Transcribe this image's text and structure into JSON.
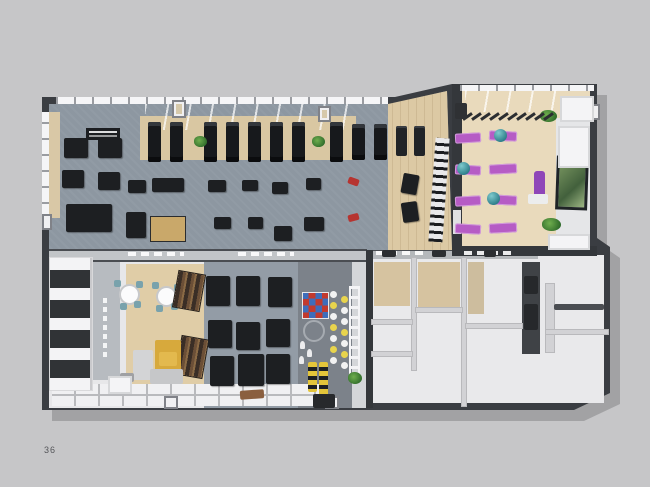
{
  "page": {
    "number": "36",
    "background": "#c6c6c8"
  },
  "scene": {
    "description": "3D top-down rendering of a fitness club floor plan on a catalogue page",
    "rooms": [
      {
        "id": "gym-hall",
        "label": "cardio and strength gym hall"
      },
      {
        "id": "functional-zone",
        "label": "functional training zone with wall bars"
      },
      {
        "id": "group-studio",
        "label": "group fitness / yoga studio"
      },
      {
        "id": "lounge-cafe",
        "label": "lounge and cafe corner"
      },
      {
        "id": "machine-zone",
        "label": "lower cardio machine zone"
      },
      {
        "id": "climbing-kids-zone",
        "label": "climbing wall and kids corner"
      },
      {
        "id": "locker-rooms",
        "label": "locker and changing rooms"
      },
      {
        "id": "storage-shelving",
        "label": "storage shelving wall"
      }
    ],
    "equipment_counts": {
      "treadmills": 8,
      "exercise_bikes": 2,
      "weight_towers": 2,
      "strength_machines": 21,
      "yoga_mats": 8,
      "gym_balls": 3,
      "cafe_tables": 2,
      "cafe_chairs": 8,
      "bookshelves": 2,
      "sofas": 1,
      "climbing_hold_panels": 1,
      "rope_ladders": 1,
      "plants": 7
    },
    "colors": {
      "wall_dark": "#3a3d42",
      "gym_carpet": "#8d97a1",
      "wood_floor": "#dcc9a4",
      "studio_wood": "#e9dabc",
      "white_room": "#e9e9eb",
      "tan_wall": "#d6c3a0",
      "mat_purple": "#b65cc5",
      "ball_teal": "#2e7f8a",
      "sofa_yellow": "#d7a93c",
      "accent_red": "#b63430",
      "plant_green": "#2f6b2a",
      "hold_red": "#c23a2e",
      "hold_blue": "#3e6dbb"
    }
  },
  "sprites": [
    {
      "n": "treadmill",
      "t": "tread",
      "x": 148,
      "y": 122,
      "w": 13,
      "h": 40
    },
    {
      "n": "treadmill",
      "t": "tread",
      "x": 170,
      "y": 122,
      "w": 13,
      "h": 40
    },
    {
      "n": "treadmill",
      "t": "tread",
      "x": 204,
      "y": 122,
      "w": 13,
      "h": 40
    },
    {
      "n": "treadmill",
      "t": "tread",
      "x": 226,
      "y": 122,
      "w": 13,
      "h": 40
    },
    {
      "n": "treadmill",
      "t": "tread",
      "x": 248,
      "y": 122,
      "w": 13,
      "h": 40
    },
    {
      "n": "treadmill",
      "t": "tread",
      "x": 270,
      "y": 122,
      "w": 13,
      "h": 40
    },
    {
      "n": "treadmill",
      "t": "tread",
      "x": 292,
      "y": 122,
      "w": 13,
      "h": 40
    },
    {
      "n": "treadmill",
      "t": "tread",
      "x": 330,
      "y": 122,
      "w": 13,
      "h": 40
    },
    {
      "n": "exercise-bike",
      "t": "tread",
      "x": 352,
      "y": 124,
      "w": 13,
      "h": 36
    },
    {
      "n": "exercise-bike",
      "t": "tread",
      "x": 374,
      "y": 124,
      "w": 13,
      "h": 36
    },
    {
      "n": "weight-tower",
      "t": "tower",
      "x": 396,
      "y": 126,
      "w": 11,
      "h": 30
    },
    {
      "n": "weight-tower",
      "t": "tower",
      "x": 414,
      "y": 126,
      "w": 11,
      "h": 30
    },
    {
      "n": "plant",
      "t": "plant",
      "x": 194,
      "y": 136,
      "w": 13,
      "h": 11
    },
    {
      "n": "plant",
      "t": "plant",
      "x": 312,
      "y": 136,
      "w": 13,
      "h": 11
    },
    {
      "n": "bench-station",
      "t": "mach",
      "x": 64,
      "y": 138,
      "w": 24,
      "h": 20
    },
    {
      "n": "bench-station",
      "t": "mach",
      "x": 98,
      "y": 138,
      "w": 24,
      "h": 20
    },
    {
      "n": "bench-station",
      "t": "mach",
      "x": 62,
      "y": 170,
      "w": 22,
      "h": 18
    },
    {
      "n": "bench-station",
      "t": "mach",
      "x": 98,
      "y": 172,
      "w": 22,
      "h": 18
    },
    {
      "n": "cable-crossover",
      "t": "mach",
      "x": 66,
      "y": 204,
      "w": 46,
      "h": 28
    },
    {
      "n": "gym-machine",
      "t": "mach",
      "x": 128,
      "y": 180,
      "w": 18,
      "h": 13
    },
    {
      "n": "gym-machine",
      "t": "mach",
      "x": 152,
      "y": 178,
      "w": 32,
      "h": 14
    },
    {
      "n": "gym-machine",
      "t": "mach",
      "x": 208,
      "y": 180,
      "w": 18,
      "h": 12
    },
    {
      "n": "gym-machine",
      "t": "mach",
      "x": 242,
      "y": 180,
      "w": 16,
      "h": 11
    },
    {
      "n": "gym-machine",
      "t": "mach",
      "x": 272,
      "y": 182,
      "w": 16,
      "h": 12
    },
    {
      "n": "gym-machine",
      "t": "mach",
      "x": 306,
      "y": 178,
      "w": 15,
      "h": 12
    },
    {
      "n": "gym-machine",
      "t": "mach",
      "x": 126,
      "y": 212,
      "w": 20,
      "h": 26
    },
    {
      "n": "wooden-machine",
      "t": "wmach",
      "x": 150,
      "y": 216,
      "w": 36,
      "h": 26
    },
    {
      "n": "gym-machine",
      "t": "mach",
      "x": 214,
      "y": 217,
      "w": 17,
      "h": 12
    },
    {
      "n": "gym-machine",
      "t": "mach",
      "x": 248,
      "y": 217,
      "w": 15,
      "h": 12
    },
    {
      "n": "gym-machine",
      "t": "mach",
      "x": 274,
      "y": 226,
      "w": 18,
      "h": 15
    },
    {
      "n": "gym-machine",
      "t": "mach",
      "x": 304,
      "y": 217,
      "w": 20,
      "h": 14
    },
    {
      "n": "dumbbell-rack",
      "t": "mach",
      "x": 402,
      "y": 174,
      "w": 16,
      "h": 20,
      "r": 10
    },
    {
      "n": "dumbbell-rack",
      "t": "mach",
      "x": 402,
      "y": 202,
      "w": 16,
      "h": 20,
      "r": -8
    },
    {
      "n": "red-equipment",
      "t": "block",
      "x": 348,
      "y": 178,
      "w": 11,
      "h": 7,
      "c": "#b63430",
      "r": 20
    },
    {
      "n": "red-equipment",
      "t": "block",
      "x": 348,
      "y": 214,
      "w": 11,
      "h": 7,
      "c": "#b63430",
      "r": -15
    },
    {
      "n": "wall-bars",
      "t": "wallbars",
      "x": 432,
      "y": 138,
      "w": 14,
      "h": 104,
      "r": 4
    },
    {
      "n": "wall-sign",
      "t": "sign",
      "x": 86,
      "y": 128,
      "w": 34,
      "h": 12
    },
    {
      "n": "pillar",
      "t": "pillar",
      "x": 172,
      "y": 100,
      "w": 14,
      "h": 18,
      "c": "#d6c9ab"
    },
    {
      "n": "pillar",
      "t": "pillar",
      "x": 318,
      "y": 106,
      "w": 13,
      "h": 16,
      "c": "#d6c9ab"
    },
    {
      "n": "pillar",
      "t": "pillar",
      "x": 42,
      "y": 214,
      "w": 10,
      "h": 16
    },
    {
      "n": "pillar",
      "t": "pillar",
      "x": 164,
      "y": 396,
      "w": 14,
      "h": 13
    },
    {
      "n": "pillar",
      "t": "pillar",
      "x": 325,
      "y": 396,
      "w": 14,
      "h": 13
    },
    {
      "n": "pillar",
      "t": "pillar",
      "x": 588,
      "y": 104,
      "w": 12,
      "h": 16
    },
    {
      "n": "wall-signage",
      "t": "dash",
      "x": 128,
      "y": 252,
      "w": 56,
      "h": 4
    },
    {
      "n": "wall-signage",
      "t": "dash",
      "x": 238,
      "y": 252,
      "w": 56,
      "h": 4
    },
    {
      "n": "wall-signage",
      "t": "dash",
      "x": 376,
      "y": 251,
      "w": 52,
      "h": 4
    },
    {
      "n": "wall-signage",
      "t": "dash",
      "x": 464,
      "y": 251,
      "w": 52,
      "h": 4
    },
    {
      "n": "wall-signage-vertical",
      "t": "vdash",
      "x": 103,
      "y": 298,
      "w": 4,
      "h": 62
    },
    {
      "n": "yoga-mat",
      "t": "mat",
      "x": 455,
      "y": 133,
      "w": 26,
      "h": 10,
      "r": -3
    },
    {
      "n": "yoga-mat",
      "t": "mat",
      "x": 489,
      "y": 131,
      "w": 28,
      "h": 10,
      "r": 3
    },
    {
      "n": "yoga-mat",
      "t": "mat",
      "x": 455,
      "y": 165,
      "w": 26,
      "h": 10,
      "r": 3
    },
    {
      "n": "yoga-mat",
      "t": "mat",
      "x": 489,
      "y": 164,
      "w": 28,
      "h": 10,
      "r": -3
    },
    {
      "n": "yoga-mat",
      "t": "mat",
      "x": 455,
      "y": 196,
      "w": 26,
      "h": 10,
      "r": -3
    },
    {
      "n": "yoga-mat",
      "t": "mat",
      "x": 489,
      "y": 195,
      "w": 28,
      "h": 10,
      "r": 3
    },
    {
      "n": "yoga-mat",
      "t": "mat",
      "x": 455,
      "y": 224,
      "w": 26,
      "h": 10,
      "r": 3
    },
    {
      "n": "yoga-mat",
      "t": "mat",
      "x": 489,
      "y": 223,
      "w": 28,
      "h": 10,
      "r": -3
    },
    {
      "n": "gym-ball",
      "t": "ball",
      "x": 494,
      "y": 129,
      "w": 13,
      "h": 13
    },
    {
      "n": "gym-ball",
      "t": "ball",
      "x": 457,
      "y": 162,
      "w": 13,
      "h": 13
    },
    {
      "n": "gym-ball",
      "t": "ball",
      "x": 487,
      "y": 192,
      "w": 13,
      "h": 13
    },
    {
      "n": "rolled-mat",
      "t": "roll",
      "x": 534,
      "y": 171,
      "w": 11,
      "h": 27
    },
    {
      "n": "white-bench",
      "t": "block",
      "x": 528,
      "y": 194,
      "w": 20,
      "h": 10,
      "c": "#eceded"
    },
    {
      "n": "wall-art",
      "t": "art",
      "x": 556,
      "y": 156,
      "w": 32,
      "h": 54,
      "r": 2
    },
    {
      "n": "plant",
      "t": "plant",
      "x": 540,
      "y": 110,
      "w": 17,
      "h": 12
    },
    {
      "n": "plant",
      "t": "plant",
      "x": 542,
      "y": 218,
      "w": 19,
      "h": 13
    },
    {
      "n": "pergola-beam",
      "t": "beam",
      "x": 466,
      "y": 111,
      "w": 3,
      "h": 11,
      "r": 55
    },
    {
      "n": "pergola-beam",
      "t": "beam",
      "x": 475,
      "y": 111,
      "w": 3,
      "h": 11,
      "r": 55
    },
    {
      "n": "pergola-beam",
      "t": "beam",
      "x": 484,
      "y": 111,
      "w": 3,
      "h": 11,
      "r": 55
    },
    {
      "n": "pergola-beam",
      "t": "beam",
      "x": 493,
      "y": 111,
      "w": 3,
      "h": 11,
      "r": 55
    },
    {
      "n": "pergola-beam",
      "t": "beam",
      "x": 502,
      "y": 111,
      "w": 3,
      "h": 11,
      "r": 55
    },
    {
      "n": "pergola-beam",
      "t": "beam",
      "x": 511,
      "y": 111,
      "w": 3,
      "h": 11,
      "r": 55
    },
    {
      "n": "pergola-beam",
      "t": "beam",
      "x": 520,
      "y": 111,
      "w": 3,
      "h": 11,
      "r": 55
    },
    {
      "n": "pergola-beam",
      "t": "beam",
      "x": 529,
      "y": 111,
      "w": 3,
      "h": 11,
      "r": 55
    },
    {
      "n": "pergola-beam",
      "t": "beam",
      "x": 538,
      "y": 111,
      "w": 3,
      "h": 11,
      "r": 55
    },
    {
      "n": "pergola-beam",
      "t": "beam",
      "x": 547,
      "y": 111,
      "w": 3,
      "h": 11,
      "r": 55
    },
    {
      "n": "speaker-cabinet",
      "t": "block",
      "x": 455,
      "y": 103,
      "w": 12,
      "h": 16,
      "c": "#2f3134"
    },
    {
      "n": "white-cabinet",
      "t": "cab",
      "x": 558,
      "y": 126,
      "w": 32,
      "h": 42
    },
    {
      "n": "white-cabinet",
      "t": "cab",
      "x": 548,
      "y": 234,
      "w": 42,
      "h": 16
    },
    {
      "n": "window-block",
      "t": "cab",
      "x": 560,
      "y": 96,
      "w": 34,
      "h": 26
    },
    {
      "n": "cafe-table",
      "t": "table",
      "x": 121,
      "y": 286,
      "w": 17,
      "h": 17
    },
    {
      "n": "cafe-table",
      "t": "table",
      "x": 158,
      "y": 288,
      "w": 17,
      "h": 17
    },
    {
      "n": "cafe-chair",
      "t": "chair",
      "x": 114,
      "y": 280,
      "w": 7,
      "h": 7
    },
    {
      "n": "cafe-chair",
      "t": "chair",
      "x": 136,
      "y": 281,
      "w": 7,
      "h": 7
    },
    {
      "n": "cafe-chair",
      "t": "chair",
      "x": 120,
      "y": 303,
      "w": 7,
      "h": 7
    },
    {
      "n": "cafe-chair",
      "t": "chair",
      "x": 134,
      "y": 301,
      "w": 7,
      "h": 7
    },
    {
      "n": "cafe-chair",
      "t": "chair",
      "x": 152,
      "y": 282,
      "w": 7,
      "h": 7
    },
    {
      "n": "cafe-chair",
      "t": "chair",
      "x": 174,
      "y": 284,
      "w": 7,
      "h": 7
    },
    {
      "n": "cafe-chair",
      "t": "chair",
      "x": 156,
      "y": 305,
      "w": 7,
      "h": 7
    },
    {
      "n": "cafe-chair",
      "t": "chair",
      "x": 171,
      "y": 303,
      "w": 7,
      "h": 7
    },
    {
      "n": "bookshelf",
      "t": "shelf",
      "x": 176,
      "y": 273,
      "w": 26,
      "h": 36,
      "r": 10
    },
    {
      "n": "bookshelf",
      "t": "shelf",
      "x": 179,
      "y": 338,
      "w": 26,
      "h": 38,
      "r": 10
    },
    {
      "n": "sofa-back",
      "t": "sofa",
      "x": 155,
      "y": 340,
      "w": 26,
      "h": 36,
      "c": "#d7a93c"
    },
    {
      "n": "sofa-chaise",
      "t": "sofa",
      "x": 133,
      "y": 350,
      "w": 20,
      "h": 30,
      "c": "#d3d4d6"
    },
    {
      "n": "sofa-seat",
      "t": "sofa",
      "x": 150,
      "y": 369,
      "w": 33,
      "h": 15,
      "c": "#c6c7c9"
    },
    {
      "n": "sofa-cushion",
      "t": "sofa",
      "x": 159,
      "y": 352,
      "w": 18,
      "h": 14,
      "c": "#e3b94e"
    },
    {
      "n": "coffee-table",
      "t": "block",
      "x": 120,
      "y": 373,
      "w": 14,
      "h": 9,
      "c": "#9fa0a3"
    },
    {
      "n": "storage-shelving",
      "t": "unit",
      "x": 50,
      "y": 258,
      "w": 42,
      "h": 132
    },
    {
      "n": "white-cabinet",
      "t": "cab",
      "x": 108,
      "y": 376,
      "w": 24,
      "h": 18
    },
    {
      "n": "door-rug",
      "t": "block",
      "x": 240,
      "y": 390,
      "w": 24,
      "h": 9,
      "c": "#8a5f3f",
      "r": -4
    },
    {
      "n": "cardio-machine",
      "t": "mach",
      "x": 206,
      "y": 276,
      "w": 24,
      "h": 30
    },
    {
      "n": "cardio-machine",
      "t": "mach",
      "x": 236,
      "y": 276,
      "w": 24,
      "h": 30
    },
    {
      "n": "cardio-machine",
      "t": "mach",
      "x": 268,
      "y": 277,
      "w": 24,
      "h": 30
    },
    {
      "n": "cardio-machine",
      "t": "mach",
      "x": 208,
      "y": 320,
      "w": 24,
      "h": 28
    },
    {
      "n": "cardio-machine",
      "t": "mach",
      "x": 236,
      "y": 322,
      "w": 24,
      "h": 28
    },
    {
      "n": "cardio-machine",
      "t": "mach",
      "x": 266,
      "y": 319,
      "w": 24,
      "h": 28
    },
    {
      "n": "cardio-machine",
      "t": "mach",
      "x": 210,
      "y": 356,
      "w": 24,
      "h": 30
    },
    {
      "n": "cardio-machine",
      "t": "mach",
      "x": 238,
      "y": 354,
      "w": 26,
      "h": 32
    },
    {
      "n": "cardio-machine",
      "t": "mach",
      "x": 266,
      "y": 354,
      "w": 24,
      "h": 30
    },
    {
      "n": "climbing-holds-panel",
      "t": "holds",
      "x": 302,
      "y": 292,
      "w": 27,
      "h": 27
    },
    {
      "n": "climbing-hold",
      "t": "dot",
      "x": 330,
      "y": 291,
      "w": 7,
      "h": 7,
      "c": "#f2f2f2"
    },
    {
      "n": "climbing-hold",
      "t": "dot",
      "x": 330,
      "y": 302,
      "w": 7,
      "h": 7,
      "c": "#e8d44d"
    },
    {
      "n": "climbing-hold",
      "t": "dot",
      "x": 330,
      "y": 313,
      "w": 7,
      "h": 7,
      "c": "#f2f2f2"
    },
    {
      "n": "climbing-hold",
      "t": "dot",
      "x": 330,
      "y": 324,
      "w": 7,
      "h": 7,
      "c": "#e8d44d"
    },
    {
      "n": "climbing-hold",
      "t": "dot",
      "x": 330,
      "y": 335,
      "w": 7,
      "h": 7,
      "c": "#f2f2f2"
    },
    {
      "n": "climbing-hold",
      "t": "dot",
      "x": 330,
      "y": 346,
      "w": 7,
      "h": 7,
      "c": "#e8d44d"
    },
    {
      "n": "climbing-hold",
      "t": "dot",
      "x": 330,
      "y": 357,
      "w": 7,
      "h": 7,
      "c": "#f2f2f2"
    },
    {
      "n": "climbing-hold",
      "t": "dot",
      "x": 341,
      "y": 296,
      "w": 7,
      "h": 7,
      "c": "#e8d44d"
    },
    {
      "n": "climbing-hold",
      "t": "dot",
      "x": 341,
      "y": 307,
      "w": 7,
      "h": 7,
      "c": "#f2f2f2"
    },
    {
      "n": "climbing-hold",
      "t": "dot",
      "x": 341,
      "y": 318,
      "w": 7,
      "h": 7,
      "c": "#f2f2f2"
    },
    {
      "n": "climbing-hold",
      "t": "dot",
      "x": 341,
      "y": 329,
      "w": 7,
      "h": 7,
      "c": "#e8d44d"
    },
    {
      "n": "climbing-hold",
      "t": "dot",
      "x": 341,
      "y": 340,
      "w": 7,
      "h": 7,
      "c": "#f2f2f2"
    },
    {
      "n": "climbing-hold",
      "t": "dot",
      "x": 341,
      "y": 351,
      "w": 7,
      "h": 7,
      "c": "#e8d44d"
    },
    {
      "n": "climbing-hold",
      "t": "dot",
      "x": 341,
      "y": 362,
      "w": 7,
      "h": 7,
      "c": "#f2f2f2"
    },
    {
      "n": "rope-ladder",
      "t": "lad",
      "x": 349,
      "y": 286,
      "w": 11,
      "h": 92
    },
    {
      "n": "wall-decor-ring",
      "t": "ring",
      "x": 303,
      "y": 320,
      "w": 22,
      "h": 22
    },
    {
      "n": "figure",
      "t": "fig",
      "x": 300,
      "y": 341,
      "w": 5,
      "h": 8
    },
    {
      "n": "figure",
      "t": "fig",
      "x": 307,
      "y": 349,
      "w": 5,
      "h": 8
    },
    {
      "n": "figure",
      "t": "fig",
      "x": 299,
      "y": 356,
      "w": 5,
      "h": 8
    },
    {
      "n": "kids-toy",
      "t": "toy",
      "x": 308,
      "y": 362,
      "w": 9,
      "h": 30
    },
    {
      "n": "kids-toy",
      "t": "toy",
      "x": 319,
      "y": 362,
      "w": 9,
      "h": 34
    },
    {
      "n": "plant",
      "t": "plant",
      "x": 348,
      "y": 372,
      "w": 14,
      "h": 12
    },
    {
      "n": "entrance-door",
      "t": "block",
      "x": 313,
      "y": 394,
      "w": 22,
      "h": 14,
      "c": "#27292c"
    },
    {
      "n": "locker-door",
      "t": "block",
      "x": 382,
      "y": 250,
      "w": 14,
      "h": 7,
      "c": "#2c2e31"
    },
    {
      "n": "locker-door",
      "t": "block",
      "x": 432,
      "y": 250,
      "w": 14,
      "h": 7,
      "c": "#2c2e31"
    },
    {
      "n": "locker-door",
      "t": "block",
      "x": 484,
      "y": 250,
      "w": 12,
      "h": 7,
      "c": "#2c2e31"
    },
    {
      "n": "wall-niche",
      "t": "block",
      "x": 524,
      "y": 276,
      "w": 14,
      "h": 18,
      "c": "#26282b"
    },
    {
      "n": "wall-niche",
      "t": "block",
      "x": 524,
      "y": 304,
      "w": 14,
      "h": 26,
      "c": "#26282b"
    },
    {
      "n": "wardrobe-shelf",
      "t": "block",
      "x": 554,
      "y": 304,
      "w": 50,
      "h": 6,
      "c": "#4a4d52"
    }
  ]
}
